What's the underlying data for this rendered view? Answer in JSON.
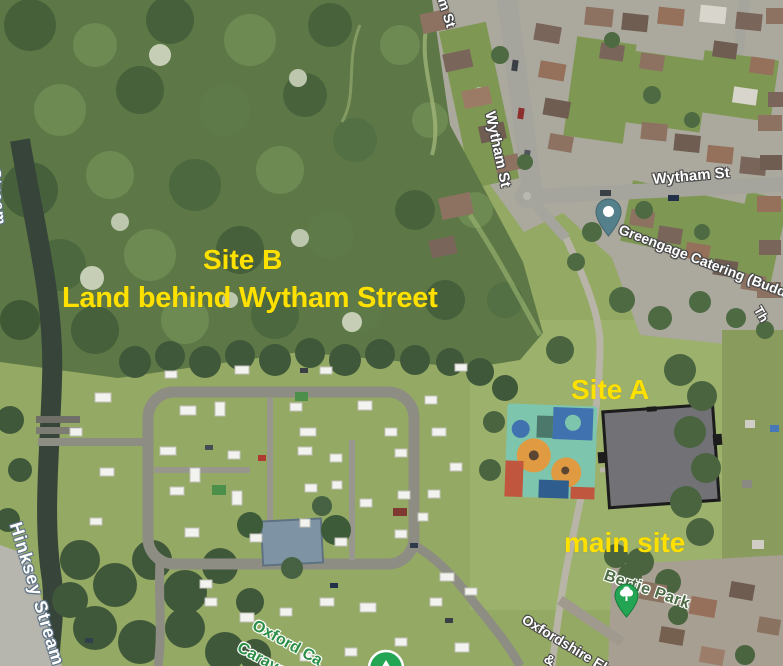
{
  "annotations": {
    "site_b_line1": "Site B",
    "site_b_line2": "Land behind Wytham Street",
    "site_a": "Site A",
    "main_site": "main site",
    "color": "#ffe100"
  },
  "map_labels": {
    "stream_fragment": "Stream",
    "hinksey_stream": "Hinksey Stream",
    "wytham_st_top_fragment": "m St",
    "wytham_st_vertical": "Wytham St",
    "wytham_st_horizontal": "Wytham St",
    "greengage_catering": "Greengage Catering (Buddh",
    "right_edge_fragment": "Th",
    "bertie_park": "Bertie Park",
    "oxfordshire_line1": "Oxfordshire Elec",
    "oxfordshire_line2": "&",
    "oxford_caravan_line1": "Oxford Ca",
    "oxford_caravan_line2": "Carava"
  },
  "icons": {
    "greengage_pin": "location-pin",
    "bertie_park_pin": "tree-pin",
    "campsite_pin": "campsite-pin"
  },
  "colors": {
    "annotation_yellow": "#ffe100",
    "poi_label_green": "#2c8f47",
    "park_label_green": "#4c6b45",
    "pin_teal": "#54808c",
    "pin_green": "#23a553"
  }
}
